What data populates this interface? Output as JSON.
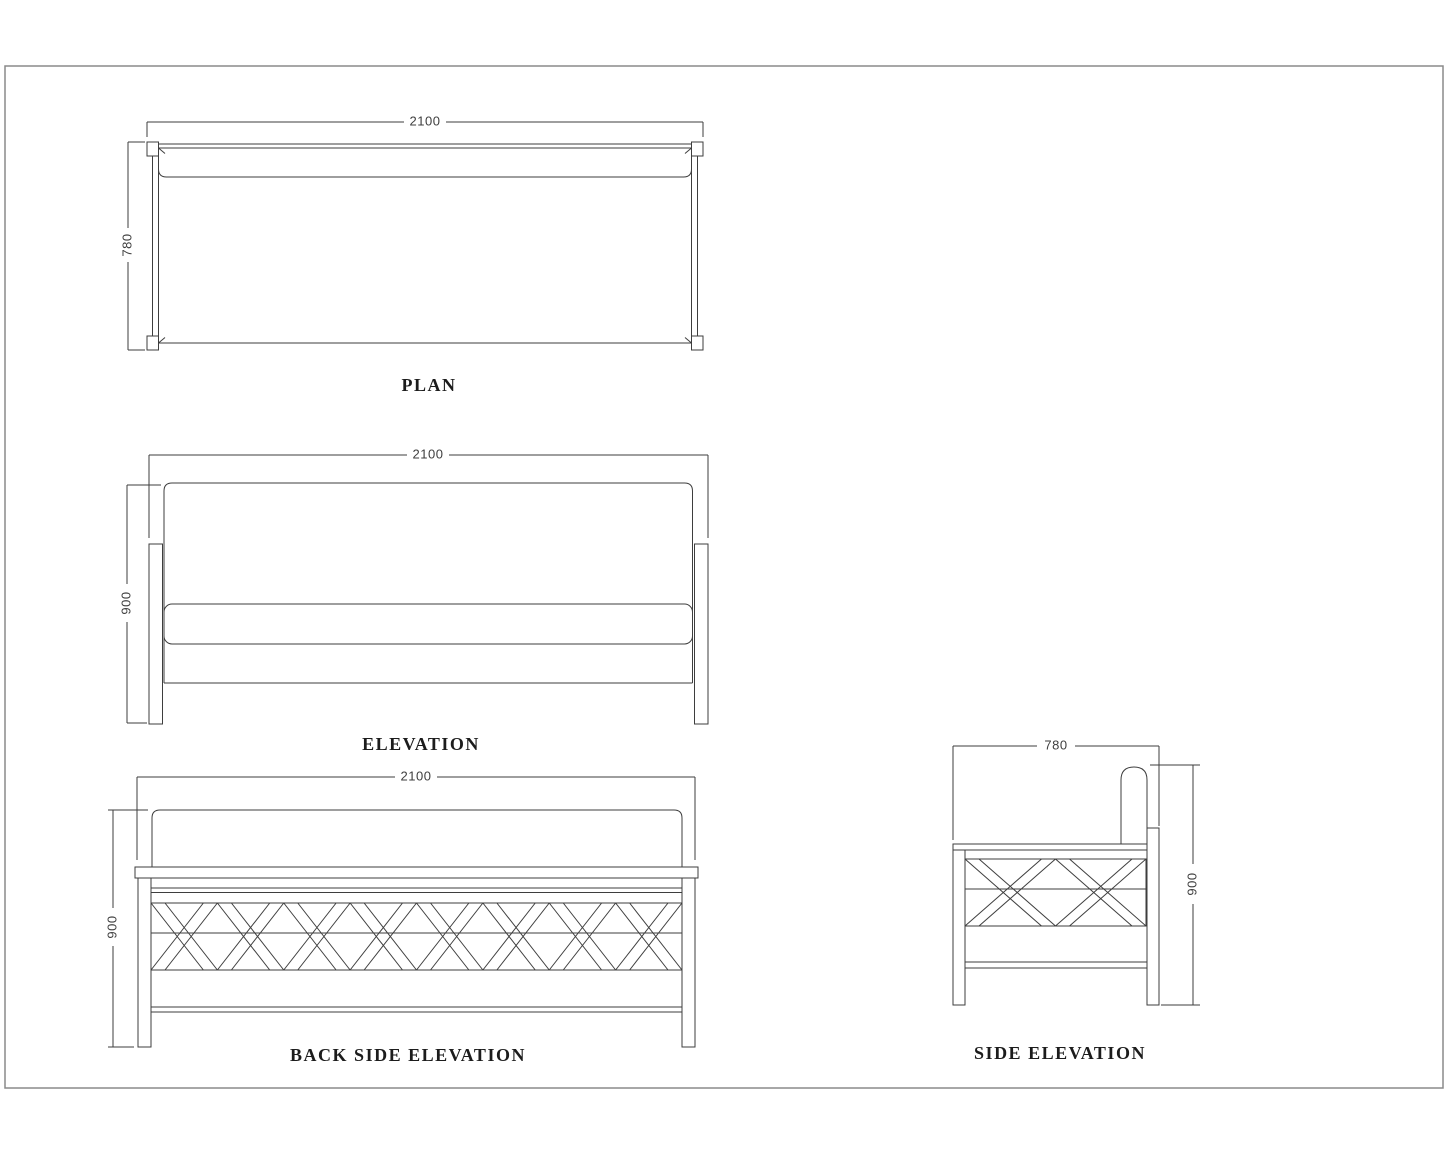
{
  "sheet": {
    "background_color": "#ffffff",
    "border_color": "#8a8a8a",
    "line_color": "#3e3e3e",
    "title_color": "#1c1c1c",
    "views": {
      "plan": {
        "title": "PLAN",
        "dim_width": "2100",
        "dim_depth": "780"
      },
      "elevation": {
        "title": "ELEVATION",
        "dim_width": "2100",
        "dim_height": "900"
      },
      "back_elevation": {
        "title": "BACK SIDE ELEVATION",
        "dim_width": "2100",
        "dim_height": "900"
      },
      "side_elevation": {
        "title": "SIDE ELEVATION",
        "dim_depth": "780",
        "dim_height": "900"
      }
    }
  }
}
